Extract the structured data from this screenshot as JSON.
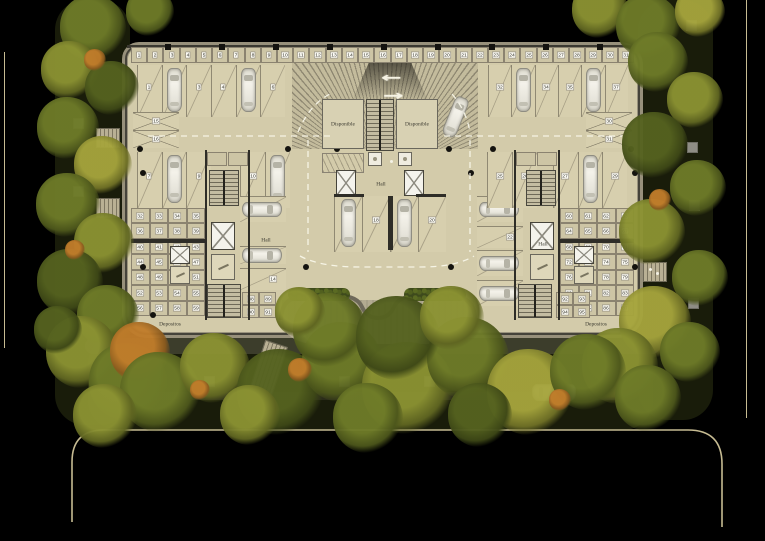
{
  "scene": {
    "type": "architectural site / basement parking floor plan",
    "texts": {
      "disponible_left": "Disponible",
      "disponible_right": "Disponible",
      "hall_center": "Hall",
      "hall_left": "Hall",
      "hall_right": "Hall",
      "depositos_left": "Depositos",
      "depositos_right": "Depositos",
      "ramp_arrow_left": "←",
      "ramp_arrow_right": "→"
    }
  },
  "parking": {
    "groups": [
      {
        "id": "top-left",
        "spots": [
          "1",
          "2",
          "3",
          "4",
          "5",
          "6"
        ],
        "cars": [
          "2",
          "5"
        ]
      },
      {
        "id": "top-right",
        "spots": [
          "32",
          "33",
          "34",
          "35",
          "36",
          "37"
        ],
        "cars": [
          "33",
          "36"
        ]
      },
      {
        "id": "left-outer",
        "spots": [
          "7",
          "8",
          "9"
        ],
        "cars": [
          "8"
        ]
      },
      {
        "id": "left-outer-b",
        "spots": [
          "10",
          "11"
        ],
        "cars": [
          "11"
        ]
      },
      {
        "id": "left-inner",
        "spots": [
          "12",
          "13",
          "14"
        ],
        "cars": [
          "12",
          "13"
        ]
      },
      {
        "id": "center",
        "spots": [
          "17",
          "18",
          "19",
          "20"
        ],
        "cars": [
          "17",
          "19"
        ]
      },
      {
        "id": "right-inner",
        "spots": [
          "21",
          "22",
          "23",
          "24"
        ],
        "cars": [
          "21",
          "23",
          "24"
        ]
      },
      {
        "id": "right-outer-b",
        "spots": [
          "25",
          "26"
        ],
        "cars": []
      },
      {
        "id": "right-outer",
        "spots": [
          "27",
          "28",
          "29"
        ],
        "cars": [
          "28"
        ]
      },
      {
        "id": "left-crossed",
        "spots": [
          "15",
          "16"
        ],
        "cars": []
      },
      {
        "id": "right-crossed",
        "spots": [
          "30",
          "31"
        ],
        "cars": []
      }
    ]
  },
  "depositos": {
    "top_row": [
      "1",
      "2",
      "3",
      "4",
      "5",
      "6",
      "7",
      "8",
      "9",
      "10",
      "11",
      "12",
      "13",
      "14",
      "15",
      "16",
      "17",
      "18",
      "19",
      "20",
      "21",
      "22",
      "23",
      "24",
      "25",
      "26",
      "27",
      "28",
      "29",
      "30",
      "31"
    ],
    "left_grid": [
      "32",
      "33",
      "34",
      "35",
      "36",
      "37",
      "38",
      "39",
      "40",
      "41",
      "42",
      "43",
      "44",
      "45",
      "46",
      "47",
      "48",
      "49",
      "50",
      "51",
      "52",
      "53",
      "54",
      "55",
      "56",
      "57",
      "58",
      "59"
    ],
    "right_grid": [
      "60",
      "61",
      "62",
      "63",
      "64",
      "65",
      "66",
      "67",
      "68",
      "69",
      "70",
      "71",
      "72",
      "73",
      "74",
      "75",
      "76",
      "77",
      "78",
      "79",
      "80",
      "81",
      "82",
      "83",
      "84",
      "85",
      "86",
      "87"
    ],
    "mini_left": [
      "88",
      "89",
      "90",
      "91"
    ],
    "mini_right": [
      "92",
      "93",
      "94",
      "95"
    ]
  },
  "colors": {
    "background": "#000000",
    "floor": "#d3cbaa",
    "spot_floor": "#d7cfae",
    "wall_dark": "#3a3830",
    "wall_mid": "#8b8370",
    "unit_fill": "#cdc5a5",
    "tag_bg": "#fcfbf4",
    "car_body": "#eeece4",
    "lane_dash": "#f6f3e4",
    "road_line": "#c6bb92",
    "paver": "#8e8d85",
    "courtyard": "#b3ab91",
    "hedge": "#3e4a1c",
    "tree_palette": [
      [
        "#55621f",
        "#3d4716"
      ],
      [
        "#6e7b28",
        "#4c561b"
      ],
      [
        "#8b9232",
        "#5f6521"
      ],
      [
        "#a5a43c",
        "#6f7026"
      ],
      [
        "#c0a93a",
        "#8a7a28"
      ],
      [
        "#c07c2a",
        "#8a5a1e"
      ],
      [
        "#97803a",
        "#6b5a28"
      ]
    ]
  }
}
